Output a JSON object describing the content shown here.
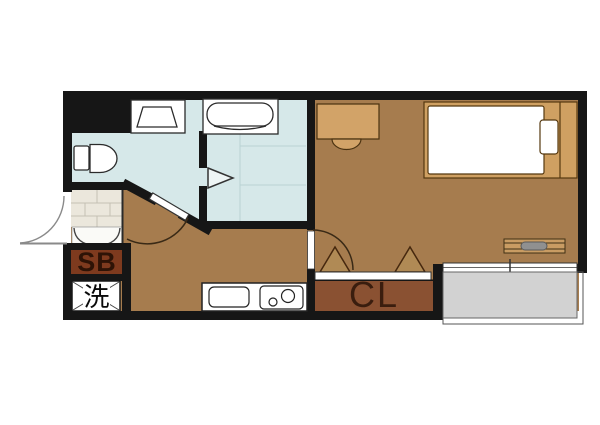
{
  "floorplan": {
    "title_hidden": "",
    "labels": {
      "shoe_box": "SB",
      "washing_machine": "洗",
      "closet": "CL"
    },
    "fixtures": [
      "entrance-door",
      "shoe-box",
      "washing-machine-pan",
      "toilet",
      "washbasin",
      "bathtub",
      "bathroom-folding-door",
      "washroom-door",
      "kitchen-counter",
      "kitchen-sink",
      "two-burner-stove",
      "room-door",
      "desk",
      "chair",
      "bed",
      "pillow",
      "window-handle",
      "closet-folding-doors",
      "balcony-sliding-door",
      "balcony"
    ],
    "colors": {
      "wall": "#161616",
      "wood_floor": "#a67c4e",
      "wet_area": "#d6e8e9",
      "wet_tile_line": "#b9d2d4",
      "genkan_tile": "#ebe7dc",
      "genkan_tile_line": "#c5c1b4",
      "closet_fill": "#8a5132",
      "shoe_box_fill": "#7e3a1e",
      "balcony_gray": "#d2d2d2",
      "furniture_tan": "#d2a368",
      "bed_frame_tan": "#cfa062",
      "fixture_outline": "#2b2b2b",
      "wood_outline": "#4a3210",
      "white": "#ffffff"
    }
  }
}
